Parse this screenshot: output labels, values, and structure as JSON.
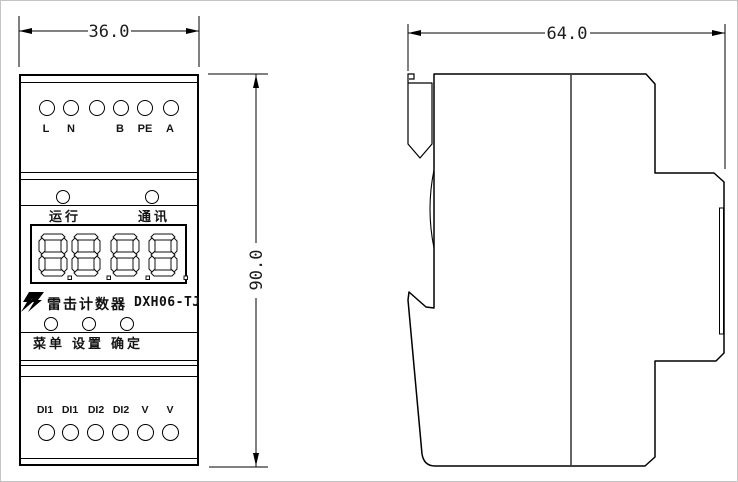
{
  "drawing": {
    "title": "DIN-rail lightning strike counter dimensional drawing",
    "front_view": {
      "top_terminals": [
        "L",
        "N",
        "",
        "B",
        "PE",
        "A"
      ],
      "indicators": [
        "运行",
        "通讯"
      ],
      "display_value": "8.8.8.8.",
      "brand_name": "雷击计数器",
      "model": "DXH06-TJ",
      "buttons": [
        "菜单",
        "设置",
        "确定"
      ],
      "bottom_terminals": [
        "DI1",
        "DI1",
        "DI2",
        "DI2",
        "V",
        "V"
      ]
    },
    "dimensions": {
      "front_width_mm": "36.0",
      "height_mm": "90.0",
      "side_depth_mm": "64.0"
    },
    "colors": {
      "line": "#000000",
      "background": "#ffffff"
    }
  }
}
